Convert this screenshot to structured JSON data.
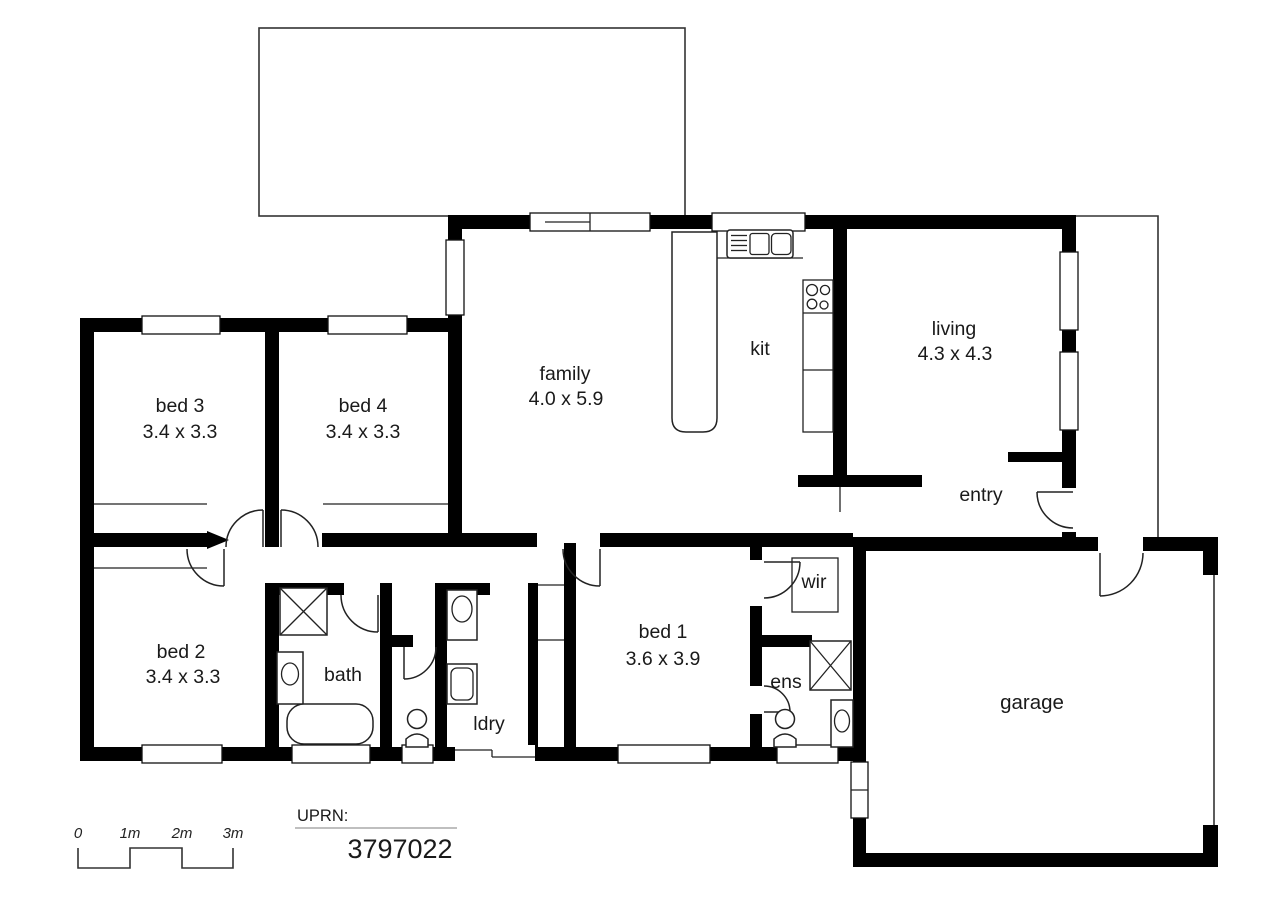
{
  "rooms": {
    "bed3": {
      "label": "bed 3",
      "dims": "3.4 x 3.3"
    },
    "bed4": {
      "label": "bed 4",
      "dims": "3.4 x 3.3"
    },
    "family": {
      "label": "family",
      "dims": "4.0 x 5.9"
    },
    "kit": {
      "label": "kit"
    },
    "living": {
      "label": "living",
      "dims": "4.3 x 4.3"
    },
    "entry": {
      "label": "entry"
    },
    "bed2": {
      "label": "bed 2",
      "dims": "3.4 x 3.3"
    },
    "bath": {
      "label": "bath"
    },
    "ldry": {
      "label": "ldry"
    },
    "bed1": {
      "label": "bed 1",
      "dims": "3.6 x 3.9"
    },
    "wir": {
      "label": "wir"
    },
    "ens": {
      "label": "ens"
    },
    "garage": {
      "label": "garage"
    }
  },
  "scale_bar": {
    "tick_labels": [
      "0",
      "1m",
      "2m",
      "3m"
    ]
  },
  "uprn": {
    "label": "UPRN:",
    "value": "3797022"
  },
  "fixtures": [
    "kitchen-sink",
    "island-bench",
    "cooktop",
    "bath-shower",
    "bath-vanity",
    "bathtub",
    "wc-toilet",
    "laundry-trough",
    "washing-machine",
    "ens-shower",
    "ens-toilet",
    "ens-vanity",
    "wir-shelf"
  ],
  "colors": {
    "wall": "#000000",
    "background": "#ffffff",
    "text": "#1a1a1a",
    "thin_line": "#333333"
  }
}
